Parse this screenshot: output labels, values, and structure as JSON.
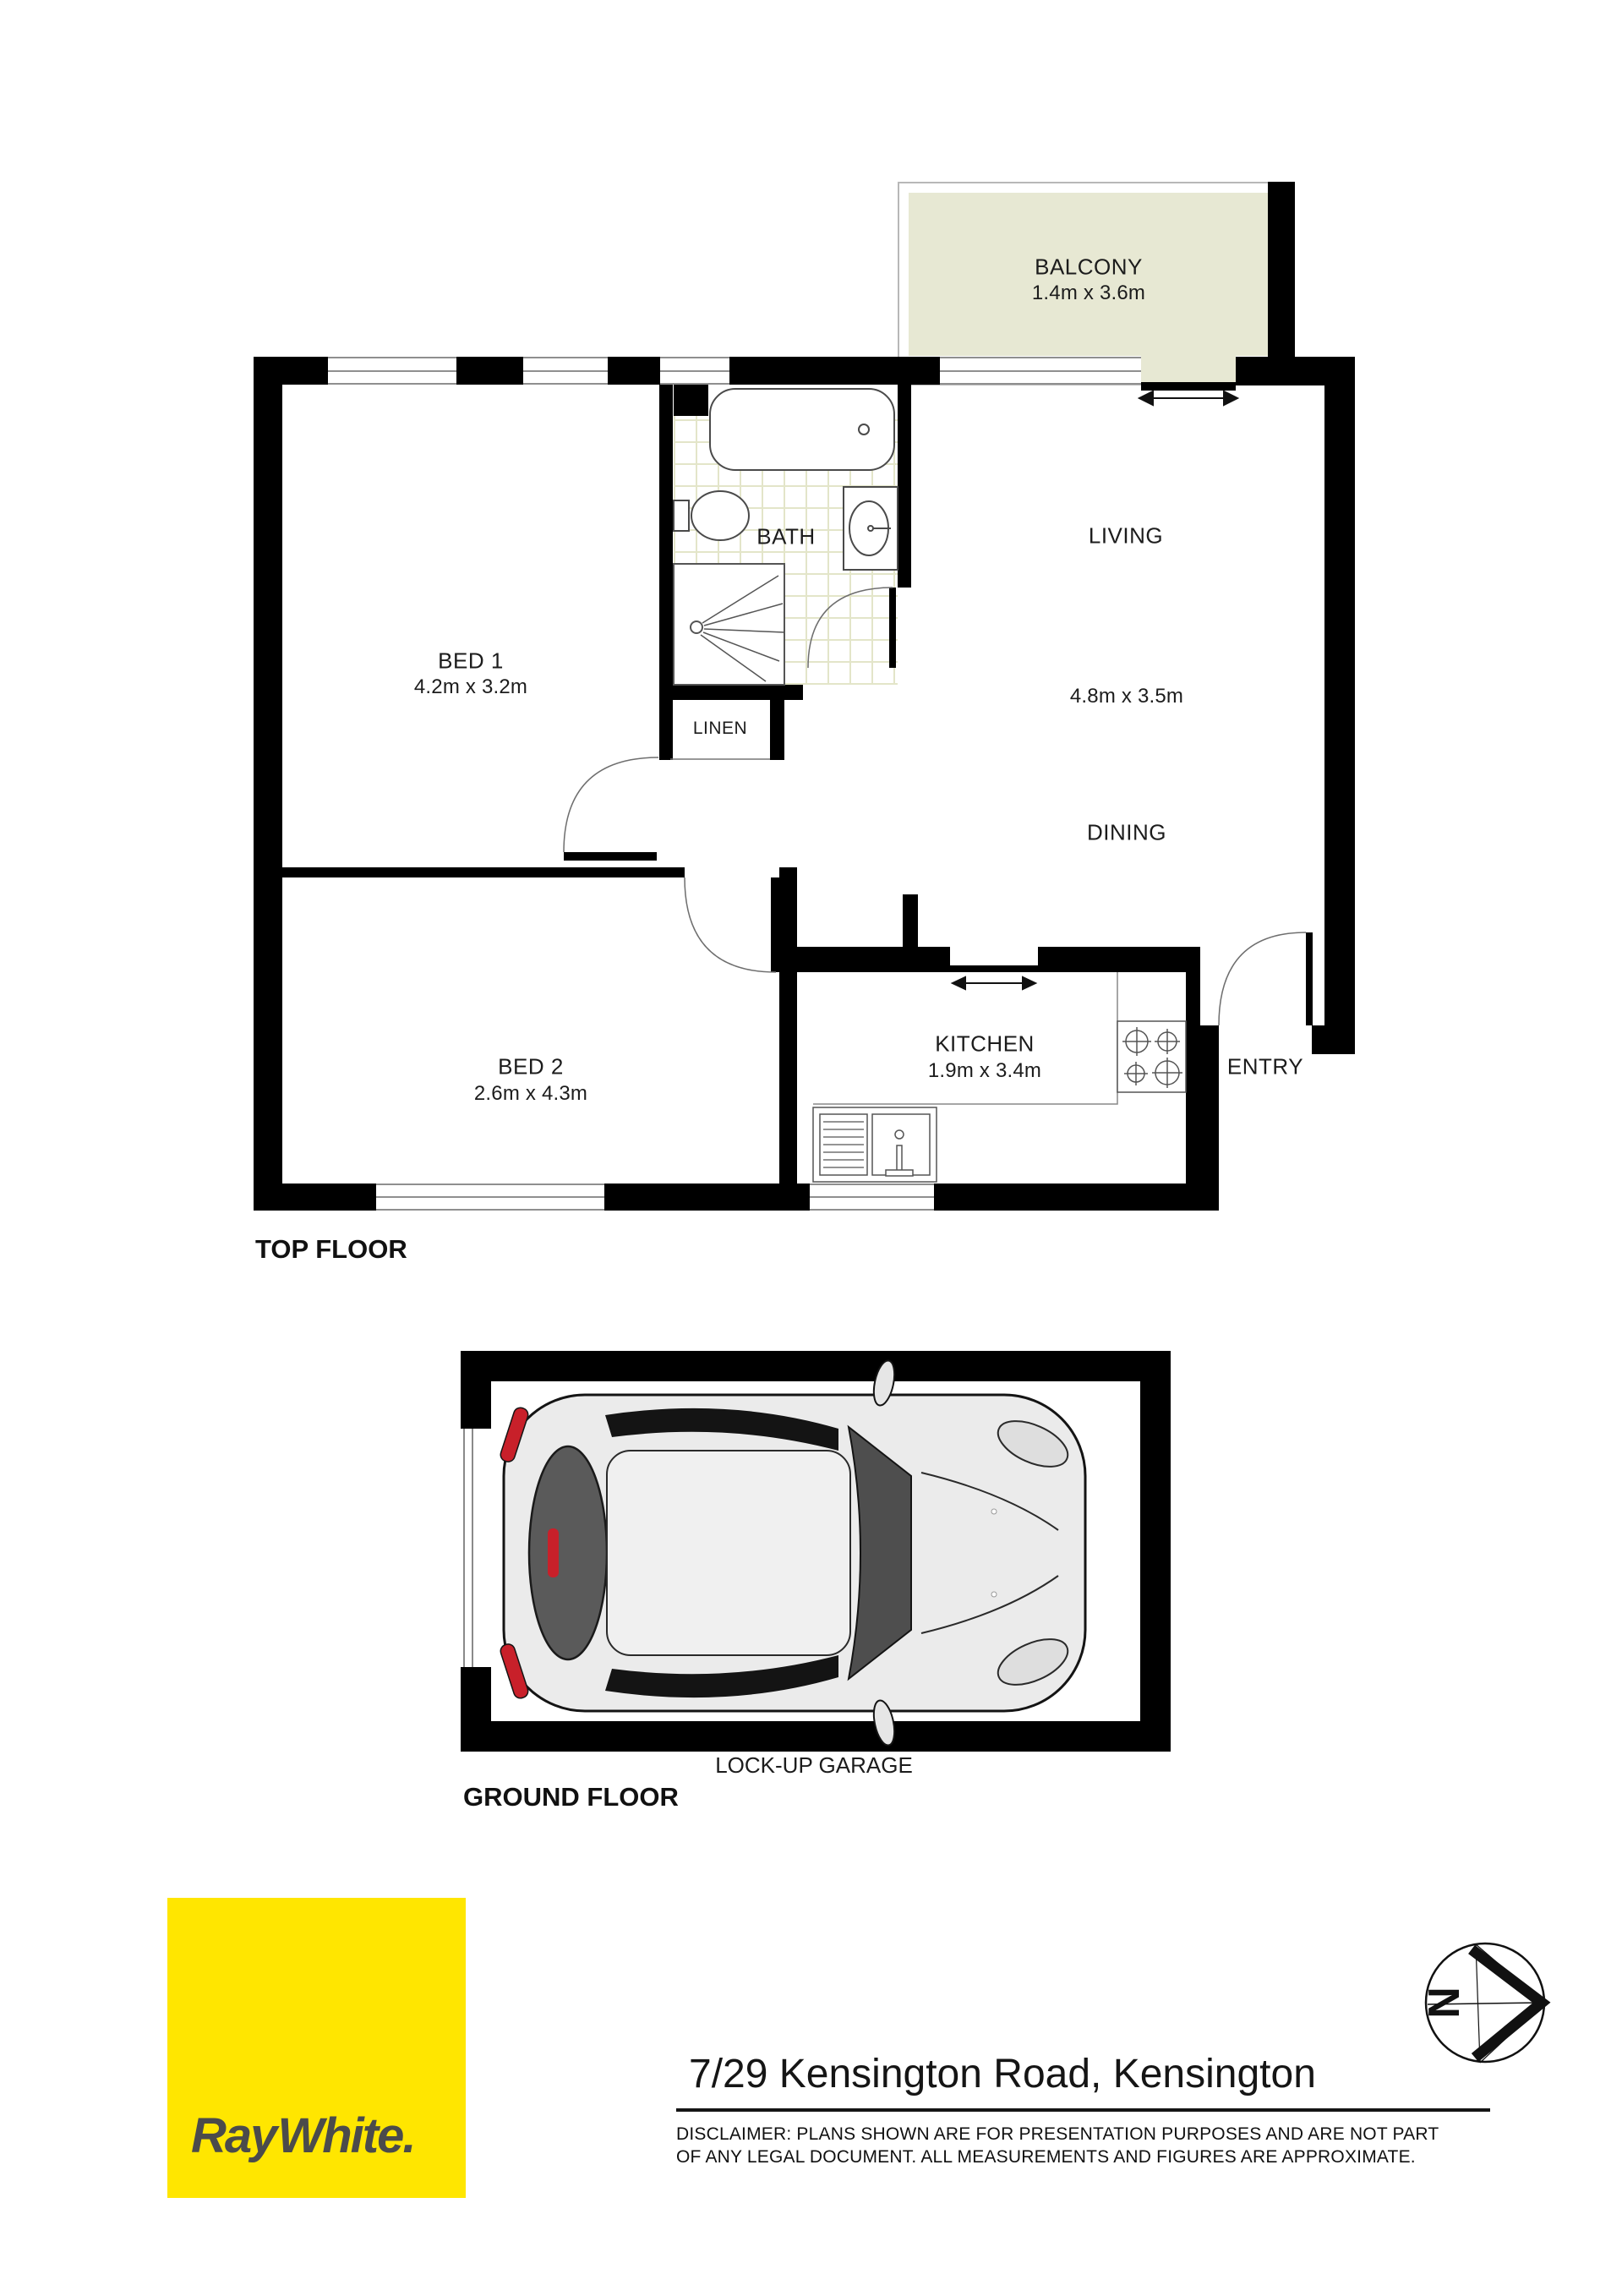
{
  "colors": {
    "wall": "#000000",
    "balcony_fill": "#e7e8d3",
    "tile_grout": "#e3e5c9",
    "logo_bg": "#ffe600",
    "logo_text": "#4b4b4b",
    "car_red": "#c8202a"
  },
  "floorplan": {
    "top_floor": {
      "label": "TOP FLOOR",
      "rooms": {
        "balcony": {
          "name": "BALCONY",
          "dims": "1.4m x 3.6m"
        },
        "bed1": {
          "name": "BED 1",
          "dims": "4.2m x 3.2m"
        },
        "bed2": {
          "name": "BED 2",
          "dims": "2.6m x 4.3m"
        },
        "bath": {
          "name": "BATH"
        },
        "living": {
          "name": "LIVING"
        },
        "living_dining_dims": "4.8m x 3.5m",
        "dining": {
          "name": "DINING"
        },
        "linen": {
          "name": "LINEN"
        },
        "kitchen": {
          "name": "KITCHEN",
          "dims": "1.9m x 3.4m"
        },
        "entry": {
          "name": "ENTRY"
        }
      }
    },
    "ground_floor": {
      "label": "GROUND FLOOR",
      "garage": {
        "name": "LOCK-UP GARAGE"
      }
    }
  },
  "footer": {
    "logo_text": "Ray White.",
    "address": "7/29 Kensington Road, Kensington",
    "disclaimer_line1": "DISCLAIMER:  PLANS SHOWN ARE FOR PRESENTATION PURPOSES AND ARE NOT PART",
    "disclaimer_line2": "OF ANY LEGAL DOCUMENT. ALL MEASUREMENTS AND FIGURES ARE APPROXIMATE.",
    "compass_letter": "N"
  }
}
